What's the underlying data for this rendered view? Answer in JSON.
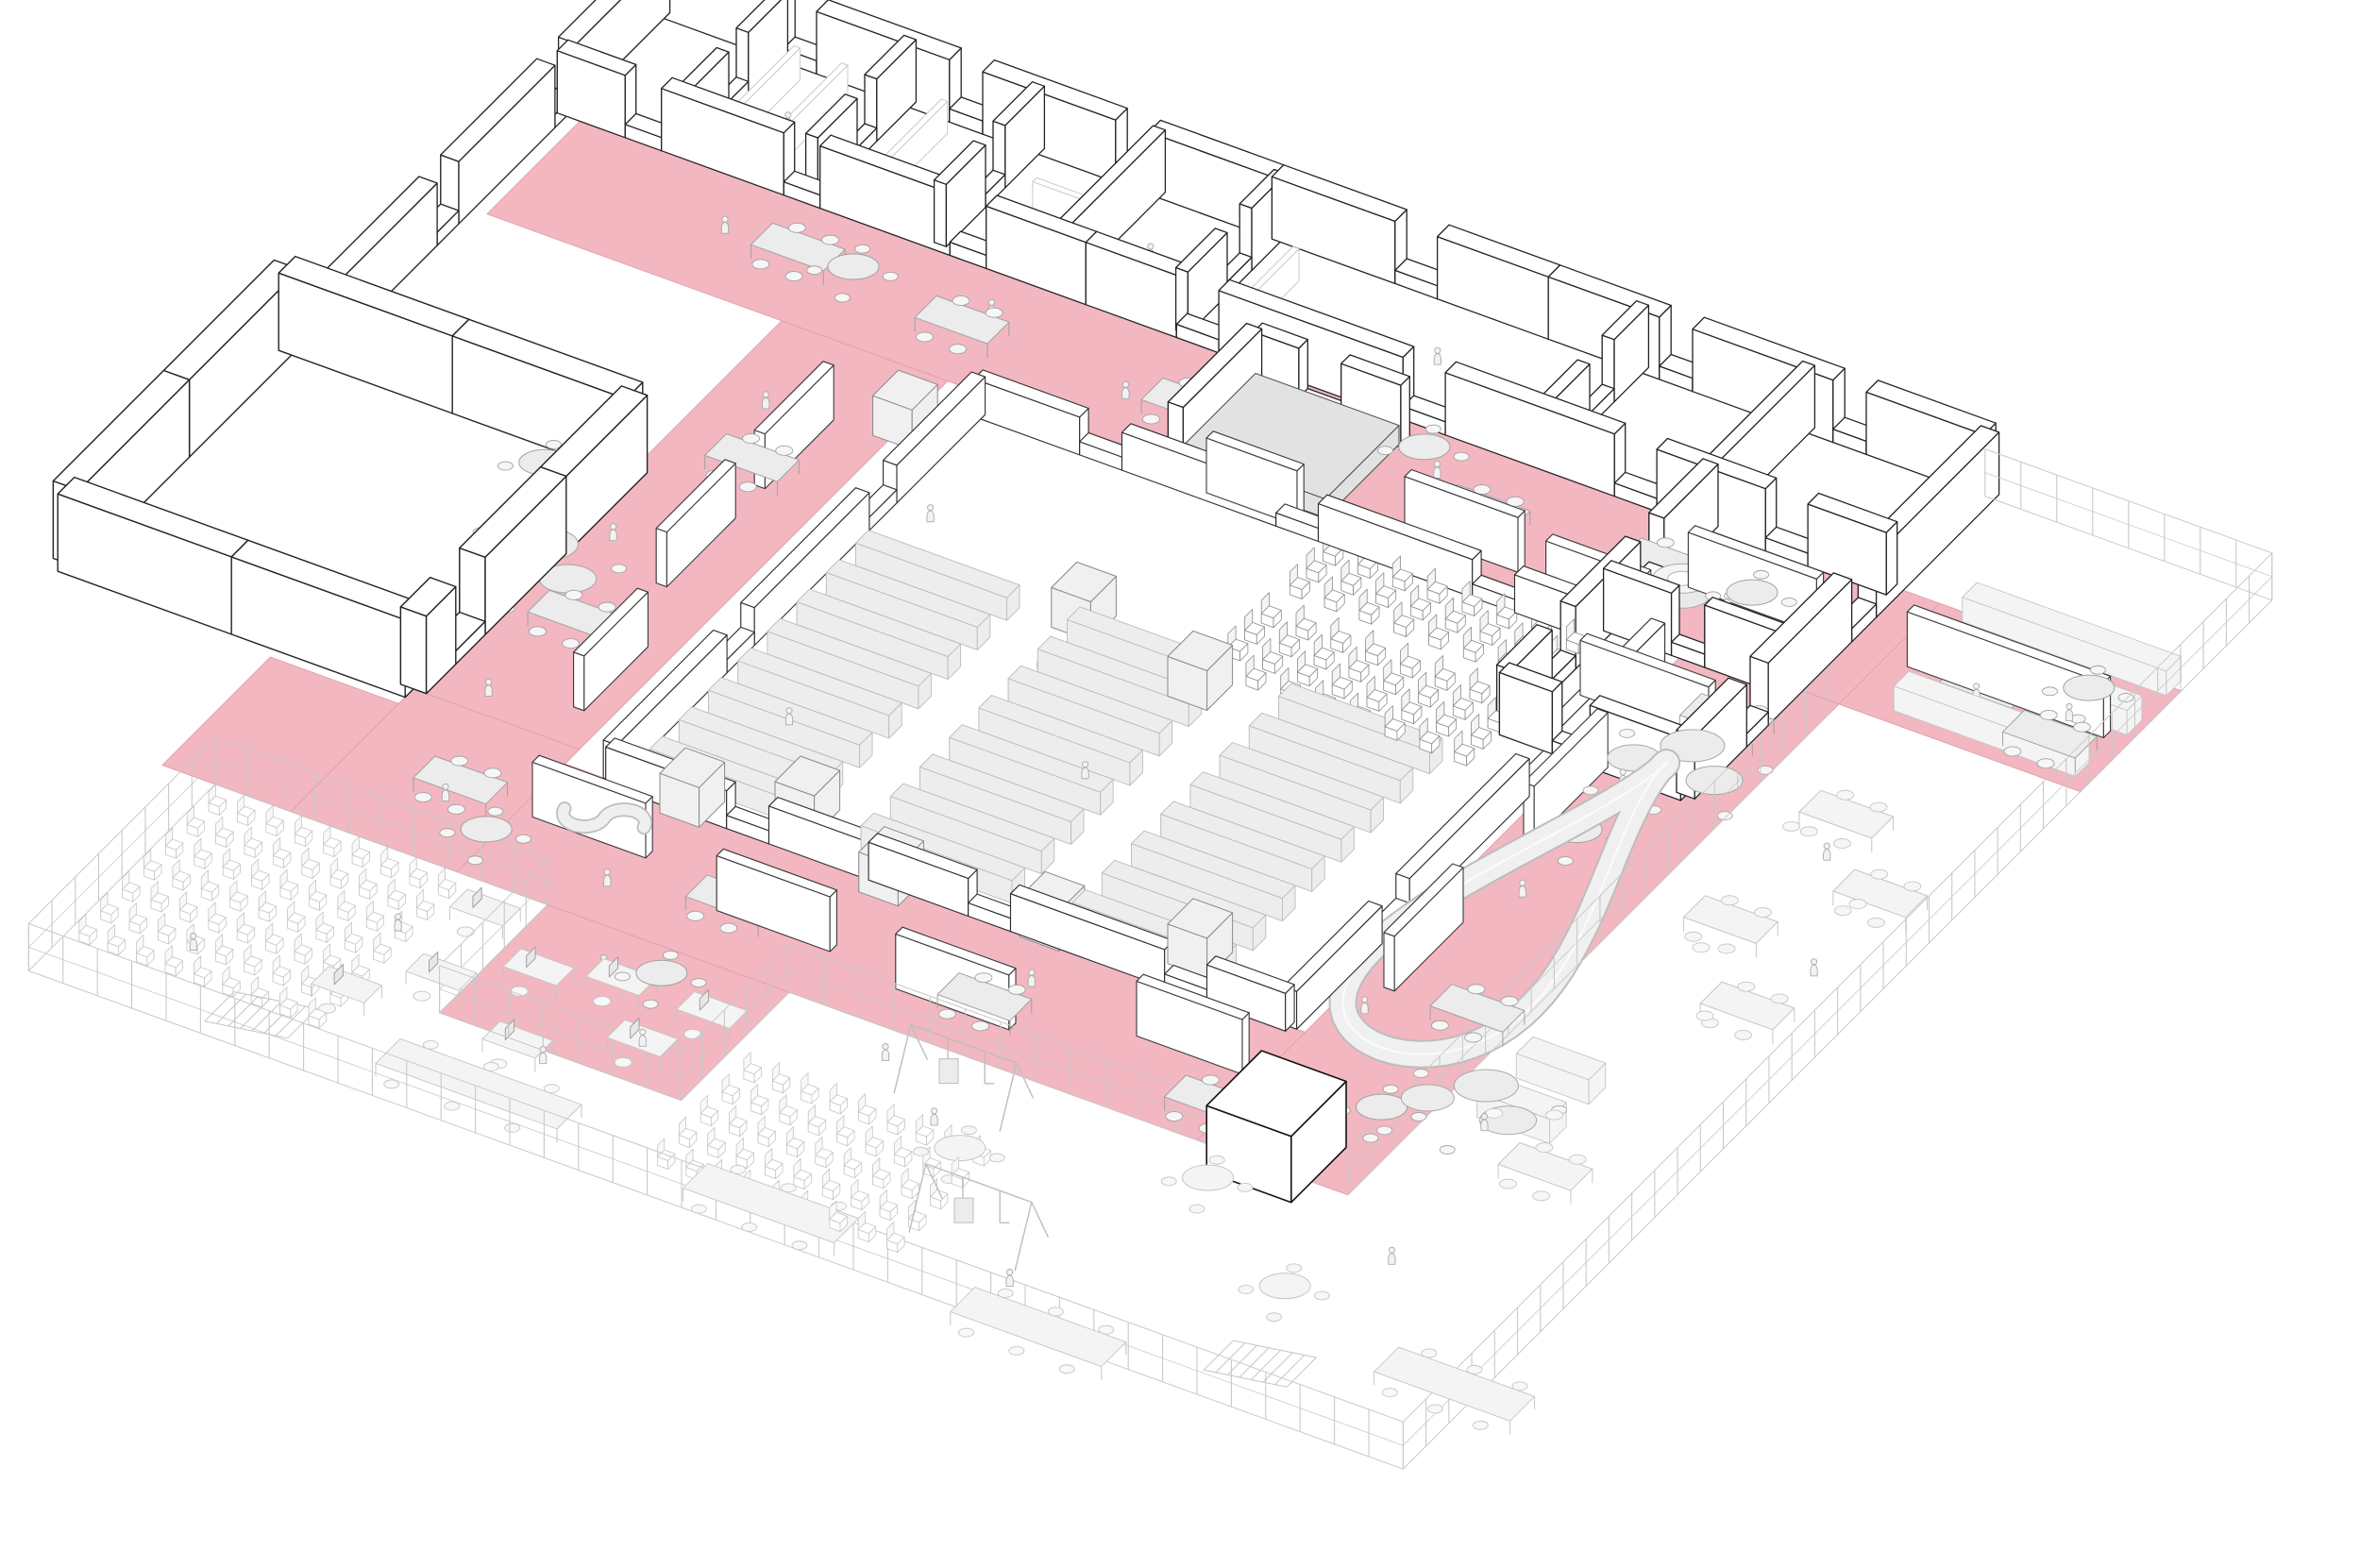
{
  "figure": {
    "kind": "axonometric-floor-plan",
    "description": "isometric line drawing of a school floor plan with pink circulation loop"
  },
  "colors": {
    "bg": "#ffffff",
    "pink": "#F2B7C0",
    "pinkEdge": "#E2A2AD",
    "wallFill": "#ffffff",
    "wallStroke": "#232323",
    "lowWallStroke": "#2e2e2e",
    "faint": "#c6c6c6",
    "faintFill": "#f4f4f4",
    "gray": "#ececec",
    "grayStroke": "#a2a2a2",
    "stageFill": "#e2e2e2",
    "stageStroke": "#555555",
    "slideBand": "#f0f0f0",
    "slideEdge": "#bdbdbd",
    "slideCenter": "#fafafa",
    "peopleFill": "#f2f2f2",
    "peopleStroke": "#a9a9a9",
    "darkBox": "#141414"
  },
  "scene": {
    "floors": [
      {
        "name": "corridor-top",
        "pts": [
          [
            30,
            195
          ],
          [
            2140,
            195
          ],
          [
            2140,
            400
          ],
          [
            30,
            400
          ]
        ]
      },
      {
        "name": "corridor-left",
        "pts": [
          [
            420,
            400
          ],
          [
            640,
            400
          ],
          [
            640,
            1400
          ],
          [
            420,
            1400
          ]
        ]
      },
      {
        "name": "corridor-bottom",
        "pts": [
          [
            250,
            1180
          ],
          [
            1780,
            1180
          ],
          [
            1780,
            1400
          ],
          [
            250,
            1400
          ]
        ]
      },
      {
        "name": "plaza-right",
        "pts": [
          [
            1620,
            400
          ],
          [
            1820,
            400
          ],
          [
            1820,
            1400
          ],
          [
            1620,
            1400
          ]
        ]
      },
      {
        "name": "plaza-right-tip",
        "pts": [
          [
            1820,
            195
          ],
          [
            2140,
            195
          ],
          [
            2140,
            400
          ],
          [
            1820,
            400
          ]
        ]
      },
      {
        "name": "pink-tongue",
        "pts": [
          [
            760,
            1400
          ],
          [
            1080,
            1400
          ],
          [
            1080,
            1620
          ],
          [
            760,
            1620
          ]
        ]
      },
      {
        "name": "annex-apron",
        "pts": [
          [
            420,
            1150
          ],
          [
            640,
            1150
          ],
          [
            640,
            1400
          ],
          [
            420,
            1400
          ]
        ]
      }
    ],
    "walls": [
      {
        "a": [
          0,
          0
        ],
        "b": [
          1760,
          0
        ],
        "t": 24,
        "h": 66,
        "gaps": [
          [
            170,
            44
          ],
          [
            390,
            44
          ],
          [
            610,
            44
          ],
          [
            980,
            56
          ],
          [
            1330,
            44
          ],
          [
            1560,
            44
          ]
        ]
      },
      {
        "a": [
          0,
          0
        ],
        "b": [
          0,
          700
        ],
        "t": 24,
        "h": 66,
        "gaps": [
          [
            190,
            44
          ],
          [
            430,
            44
          ]
        ]
      },
      {
        "a": [
          0,
          200
        ],
        "b": [
          700,
          200
        ],
        "t": 22,
        "h": 66,
        "gaps": [
          [
            90,
            48
          ],
          [
            300,
            48
          ],
          [
            520,
            48
          ]
        ]
      },
      {
        "a": [
          700,
          200
        ],
        "b": [
          1760,
          200
        ],
        "t": 22,
        "h": 66,
        "gaps": [
          [
            120,
            56
          ],
          [
            420,
            56
          ],
          [
            700,
            56
          ],
          [
            900,
            56
          ]
        ]
      },
      {
        "a": [
          160,
          0
        ],
        "b": [
          160,
          200
        ],
        "t": 16,
        "h": 66,
        "gaps": [
          [
            80,
            40
          ]
        ]
      },
      {
        "a": [
          330,
          0
        ],
        "b": [
          330,
          200
        ],
        "t": 16,
        "h": 66,
        "gaps": [
          [
            80,
            40
          ]
        ]
      },
      {
        "a": [
          500,
          0
        ],
        "b": [
          500,
          200
        ],
        "t": 16,
        "h": 66,
        "gaps": [
          [
            80,
            40
          ]
        ]
      },
      {
        "a": [
          660,
          0
        ],
        "b": [
          660,
          200
        ],
        "t": 16,
        "h": 66,
        "gaps": []
      },
      {
        "a": [
          820,
          0
        ],
        "b": [
          820,
          200
        ],
        "t": 16,
        "h": 66,
        "gaps": [
          [
            70,
            50
          ]
        ]
      },
      {
        "a": [
          1300,
          0
        ],
        "b": [
          1300,
          200
        ],
        "t": 16,
        "h": 66,
        "gaps": [
          [
            70,
            50
          ]
        ]
      },
      {
        "a": [
          1520,
          0
        ],
        "b": [
          1520,
          200
        ],
        "t": 16,
        "h": 66,
        "gaps": []
      },
      {
        "a": [
          1760,
          0
        ],
        "b": [
          1760,
          620
        ],
        "t": 24,
        "h": 66,
        "gaps": [
          [
            250,
            50
          ],
          [
            470,
            44
          ]
        ]
      },
      {
        "a": [
          1520,
          200
        ],
        "b": [
          1520,
          620
        ],
        "t": 20,
        "h": 66,
        "gaps": [
          [
            110,
            48
          ],
          [
            290,
            48
          ]
        ]
      },
      {
        "a": [
          1520,
          410
        ],
        "b": [
          1760,
          410
        ],
        "t": 16,
        "h": 66,
        "gaps": [
          [
            90,
            44
          ]
        ]
      },
      {
        "a": [
          1520,
          620
        ],
        "b": [
          1760,
          620
        ],
        "t": 20,
        "h": 66,
        "gaps": [
          [
            70,
            50
          ]
        ]
      },
      {
        "a": [
          945,
          245
        ],
        "b": [
          945,
          405
        ],
        "t": 20,
        "h": 66,
        "gaps": []
      },
      {
        "a": [
          950,
          245
        ],
        "b": [
          1145,
          245
        ],
        "t": 18,
        "h": 66,
        "gaps": [
          [
            60,
            56
          ]
        ]
      }
    ],
    "annexWalls": [
      {
        "a": [
          -40,
          700
        ],
        "b": [
          420,
          700
        ],
        "t": 34,
        "h": 82,
        "gaps": []
      },
      {
        "a": [
          -40,
          700
        ],
        "b": [
          -40,
          1150
        ],
        "t": 34,
        "h": 82,
        "gaps": []
      },
      {
        "a": [
          -40,
          1150
        ],
        "b": [
          420,
          1150
        ],
        "t": 34,
        "h": 82,
        "gaps": []
      },
      {
        "a": [
          420,
          700
        ],
        "b": [
          420,
          1150
        ],
        "t": 34,
        "h": 82,
        "gaps": [
          [
            330,
            60
          ]
        ]
      }
    ],
    "lowWalls": [
      {
        "a": [
          700,
          430
        ],
        "b": [
          1600,
          430
        ],
        "t": 18,
        "h": 40,
        "gaps": [
          [
            140,
            56
          ],
          [
            400,
            56
          ],
          [
            660,
            56
          ]
        ]
      },
      {
        "a": [
          700,
          430
        ],
        "b": [
          700,
          1180
        ],
        "t": 18,
        "h": 40,
        "gaps": [
          [
            180,
            56
          ],
          [
            470,
            56
          ]
        ]
      },
      {
        "a": [
          700,
          1180
        ],
        "b": [
          1600,
          1180
        ],
        "t": 18,
        "h": 40,
        "gaps": [
          [
            160,
            56
          ],
          [
            480,
            56
          ],
          [
            740,
            56
          ]
        ]
      },
      {
        "a": [
          1600,
          430
        ],
        "b": [
          1600,
          1180
        ],
        "t": 18,
        "h": 40,
        "gaps": [
          [
            220,
            56
          ],
          [
            520,
            56
          ]
        ]
      }
    ],
    "faintWalls": [
      {
        "a": [
          200,
          30
        ],
        "b": [
          200,
          170
        ],
        "t": 8,
        "h": 34
      },
      {
        "a": [
          263,
          30
        ],
        "b": [
          263,
          170
        ],
        "t": 8,
        "h": 34
      },
      {
        "a": [
          395,
          30
        ],
        "b": [
          395,
          170
        ],
        "t": 8,
        "h": 34
      },
      {
        "a": [
          560,
          100
        ],
        "b": [
          660,
          100
        ],
        "t": 8,
        "h": 34
      },
      {
        "a": [
          880,
          60
        ],
        "b": [
          880,
          160
        ],
        "t": 8,
        "h": 34
      }
    ],
    "panels": [
      {
        "u": 560,
        "v": 520,
        "dir": "v",
        "len": 140
      },
      {
        "u": 560,
        "v": 720,
        "dir": "v",
        "len": 140
      },
      {
        "u": 600,
        "v": 960,
        "dir": "v",
        "len": 130
      },
      {
        "u": 660,
        "v": 1270,
        "dir": "u",
        "len": 150
      },
      {
        "u": 930,
        "v": 1310,
        "dir": "u",
        "len": 150
      },
      {
        "u": 1180,
        "v": 1330,
        "dir": "u",
        "len": 150
      },
      {
        "u": 1460,
        "v": 1270,
        "dir": "u",
        "len": 140
      },
      {
        "u": 1650,
        "v": 620,
        "dir": "v",
        "len": 150
      },
      {
        "u": 1660,
        "v": 930,
        "dir": "v",
        "len": 140
      },
      {
        "u": 1230,
        "v": 370,
        "dir": "u",
        "len": 150
      },
      {
        "u": 1000,
        "v": 420,
        "dir": "u",
        "len": 120
      },
      {
        "u": 1430,
        "v": 390,
        "dir": "u",
        "len": 130
      },
      {
        "u": 1850,
        "v": 300,
        "dir": "u",
        "len": 260
      },
      {
        "u": 1560,
        "v": 300,
        "dir": "u",
        "len": 170
      },
      {
        "u": 1560,
        "v": 520,
        "dir": "u",
        "len": 170
      }
    ],
    "stage": {
      "u": 950,
      "v": 250,
      "du": 190,
      "dv": 150,
      "h": 20
    },
    "audience": {
      "u0": 1180,
      "v0": 450,
      "rows": 8,
      "cols": 7,
      "du": 46,
      "dv": 34,
      "aisleAfterCol": 3,
      "aisleGap": 24
    },
    "stalls": {
      "cols": [
        730,
        1010,
        1290
      ],
      "len": 200,
      "rows": 8,
      "v0": 700,
      "dv": 60,
      "t": 26,
      "h": 24
    },
    "cubes": [
      [
        780,
        1150
      ],
      [
        900,
        1100
      ],
      [
        1050,
        1160
      ],
      [
        1250,
        1140
      ],
      [
        1420,
        1100
      ],
      [
        980,
        660
      ],
      [
        1160,
        700
      ],
      [
        620,
        470
      ]
    ],
    "kiosk": {
      "u": 1660,
      "v": 1330,
      "s": 112,
      "h": 70
    },
    "rectTables": [
      [
        330,
        280
      ],
      [
        560,
        300
      ],
      [
        860,
        300
      ],
      [
        1250,
        300
      ],
      [
        1480,
        280
      ],
      [
        1910,
        290
      ],
      [
        2020,
        330
      ],
      [
        490,
        620
      ],
      [
        470,
        950
      ],
      [
        520,
        1260
      ],
      [
        900,
        1290
      ],
      [
        1240,
        1300
      ],
      [
        1560,
        1330
      ],
      [
        1690,
        480
      ],
      [
        1730,
        1050
      ]
    ],
    "roundTables": [
      [
        450,
        300
      ],
      [
        1180,
        260
      ],
      [
        1640,
        300
      ],
      [
        2060,
        260
      ],
      [
        1700,
        750
      ],
      [
        1780,
        1270
      ],
      [
        640,
        1340
      ],
      [
        340,
        760
      ],
      [
        950,
        1460
      ]
    ],
    "amoebas": [
      [
        420,
        880
      ],
      [
        1730,
        560
      ],
      [
        1860,
        1180
      ]
    ],
    "sofa": {
      "u": 740,
      "v": 1250
    },
    "planter": {
      "u": 1560,
      "v": 320
    },
    "slide": {
      "cu": 1715,
      "cv": 880,
      "a": 80,
      "b": 290,
      "pinch": 42
    },
    "deckBarsRight": [
      [
        1860,
        180,
        270
      ],
      [
        1860,
        260,
        270
      ],
      [
        1880,
        350,
        240
      ]
    ],
    "deckTablesRight": [
      [
        1900,
        560
      ],
      [
        2010,
        660
      ],
      [
        1890,
        780
      ],
      [
        1990,
        900
      ],
      [
        1950,
        1250
      ]
    ],
    "deckSofas": [
      [
        1870,
        1100
      ],
      [
        1870,
        1180
      ]
    ],
    "deckStools": [
      [
        1900,
        620
      ],
      [
        2040,
        700
      ],
      [
        1930,
        850
      ],
      [
        2000,
        950
      ],
      [
        1890,
        1210
      ],
      [
        1950,
        1180
      ]
    ],
    "chairBlockA": {
      "u0": 340,
      "v0": 1430,
      "rows": 7,
      "cols": 9,
      "du": 38,
      "dv": 44
    },
    "chairBlockB": {
      "u0": 1120,
      "v0": 1540,
      "rows": 5,
      "cols": 9,
      "du": 38,
      "dv": 44
    },
    "desks": [
      [
        680,
        1440
      ],
      [
        790,
        1500
      ],
      [
        700,
        1560
      ],
      [
        880,
        1470
      ],
      [
        960,
        1550
      ],
      [
        840,
        1620
      ],
      [
        620,
        1630
      ],
      [
        1000,
        1470
      ]
    ],
    "longTables": [
      [
        760,
        1700,
        240
      ],
      [
        1180,
        1720,
        200
      ],
      [
        1560,
        1760,
        200
      ],
      [
        2030,
        1620,
        180
      ]
    ],
    "swings": [
      [
        1280,
        1460
      ],
      [
        1430,
        1660
      ]
    ],
    "playTables": [
      [
        1680,
        1470
      ],
      [
        1860,
        1590
      ],
      [
        1410,
        1560
      ]
    ],
    "stairs": [
      {
        "u": 540,
        "v": 1700,
        "len": 110,
        "w": 60,
        "steps": 7
      },
      {
        "u": 1850,
        "v": 1680,
        "len": 110,
        "w": 60,
        "steps": 7
      }
    ],
    "fences": [
      [
        [
          1760,
          10
        ],
        [
          2140,
          10
        ]
      ],
      [
        [
          2140,
          10
        ],
        [
          2140,
          1780
        ]
      ],
      [
        [
          2140,
          1780
        ],
        [
          320,
          1780
        ]
      ],
      [
        [
          320,
          1780
        ],
        [
          320,
          1400
        ]
      ],
      [
        [
          320,
          1400
        ],
        [
          760,
          1400
        ]
      ],
      [
        [
          1080,
          1400
        ],
        [
          1780,
          1400
        ]
      ],
      [
        [
          760,
          1400
        ],
        [
          760,
          1620
        ]
      ],
      [
        [
          1080,
          1400
        ],
        [
          1080,
          1620
        ]
      ],
      [
        [
          760,
          1620
        ],
        [
          1080,
          1620
        ]
      ],
      [
        [
          1820,
          420
        ],
        [
          1820,
          1400
        ]
      ]
    ],
    "people": [
      [
        280,
        300
      ],
      [
        620,
        280
      ],
      [
        830,
        330
      ],
      [
        1210,
        280
      ],
      [
        1500,
        300
      ],
      [
        1720,
        290
      ],
      [
        1950,
        320
      ],
      [
        2060,
        300
      ],
      [
        490,
        540
      ],
      [
        470,
        820
      ],
      [
        500,
        1120
      ],
      [
        560,
        1300
      ],
      [
        800,
        1340
      ],
      [
        1020,
        1260
      ],
      [
        1310,
        1260
      ],
      [
        1580,
        1340
      ],
      [
        1660,
        1120
      ],
      [
        1700,
        860
      ],
      [
        1690,
        640
      ],
      [
        880,
        1470
      ],
      [
        990,
        1560
      ],
      [
        1010,
        780
      ],
      [
        1160,
        920
      ],
      [
        820,
        1000
      ],
      [
        1300,
        1060
      ],
      [
        760,
        620
      ],
      [
        1210,
        430
      ],
      [
        640,
        1520
      ],
      [
        910,
        1640
      ],
      [
        1350,
        1520
      ],
      [
        1580,
        1720
      ],
      [
        1930,
        1480
      ],
      [
        2060,
        820
      ],
      [
        1960,
        640
      ],
      [
        1890,
        1230
      ],
      [
        460,
        1660
      ],
      [
        1240,
        1450
      ],
      [
        240,
        110
      ],
      [
        720,
        110
      ],
      [
        1620,
        320
      ],
      [
        1100,
        110
      ]
    ],
    "stagePerson": [
      985,
      330
    ]
  }
}
